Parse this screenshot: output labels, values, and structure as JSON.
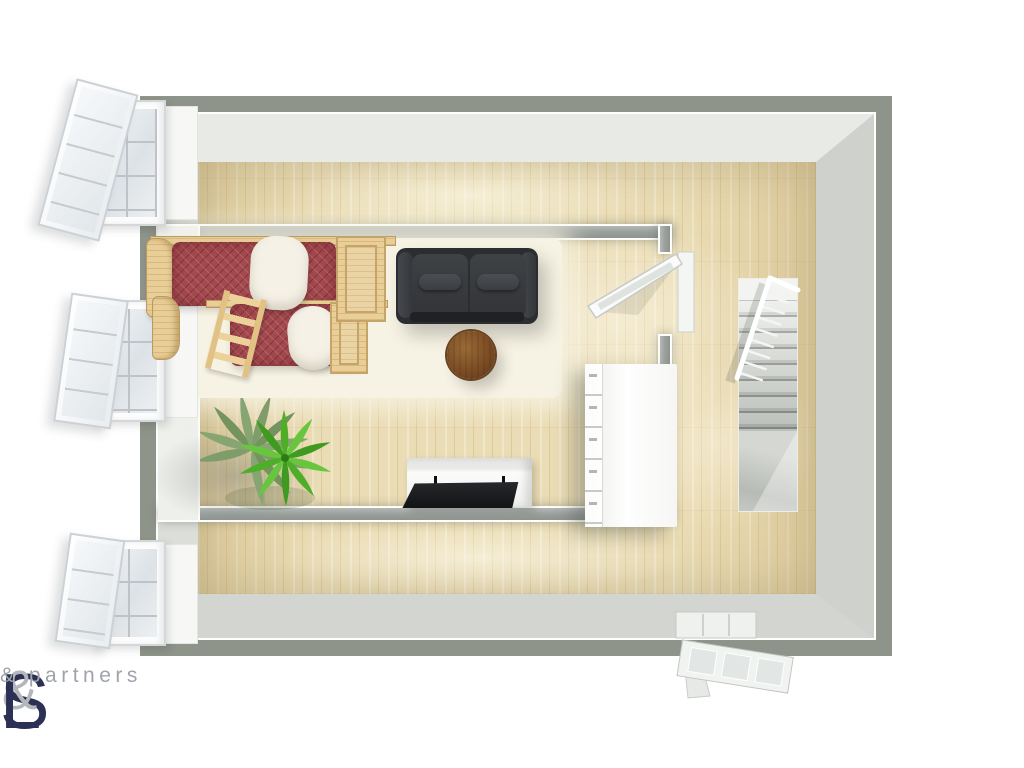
{
  "brand": {
    "logo": {
      "part_s": "S",
      "part_amp": "&",
      "part_l": "L",
      "subtitle": "& partners"
    },
    "colors": {
      "navy": "#2b3054",
      "gray": "#b3b7bc"
    }
  },
  "scene": {
    "view": "3D floor plan, top-down",
    "rooms": [
      "bedroom-living-room",
      "stair-landing"
    ],
    "furniture": [
      "bunk-bed",
      "sofa",
      "coffee-table",
      "tv-stand",
      "tv",
      "area-rug",
      "palm-plant",
      "dresser",
      "staircase"
    ],
    "openings": {
      "left_wall_windows": 3,
      "interior_door": 1,
      "exterior_door": 1
    },
    "palette": {
      "outer_wall": "#8e9489",
      "wall_face": "#dfe2dd",
      "inner_wall": "#9aa09c",
      "floor_wood": "#eadcb4",
      "rug": "#f7f3e4",
      "sofa": "#333538",
      "bed_duvet": "#a34a4f",
      "bed_wood": "#e9cf97",
      "pillow": "#f5f1e6",
      "coffee_table": "#7c4d24",
      "plant_green": "#4fae28",
      "stairs": "#d6d9d4",
      "dresser": "#f4f5f3",
      "tv": "#141517"
    }
  }
}
